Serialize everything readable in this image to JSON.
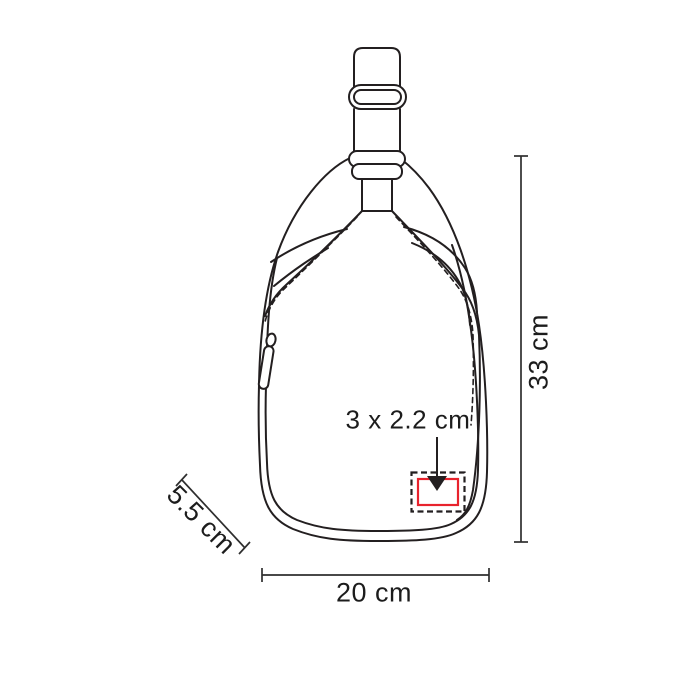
{
  "labels": {
    "height": "33 cm",
    "width": "20 cm",
    "depth": "5.5 cm",
    "print_area": "3 x 2.2 cm"
  },
  "colors": {
    "line": "#231f20",
    "dimension_line": "#2e2e2e",
    "print_area_border": "#e8232d",
    "background": "#ffffff"
  }
}
